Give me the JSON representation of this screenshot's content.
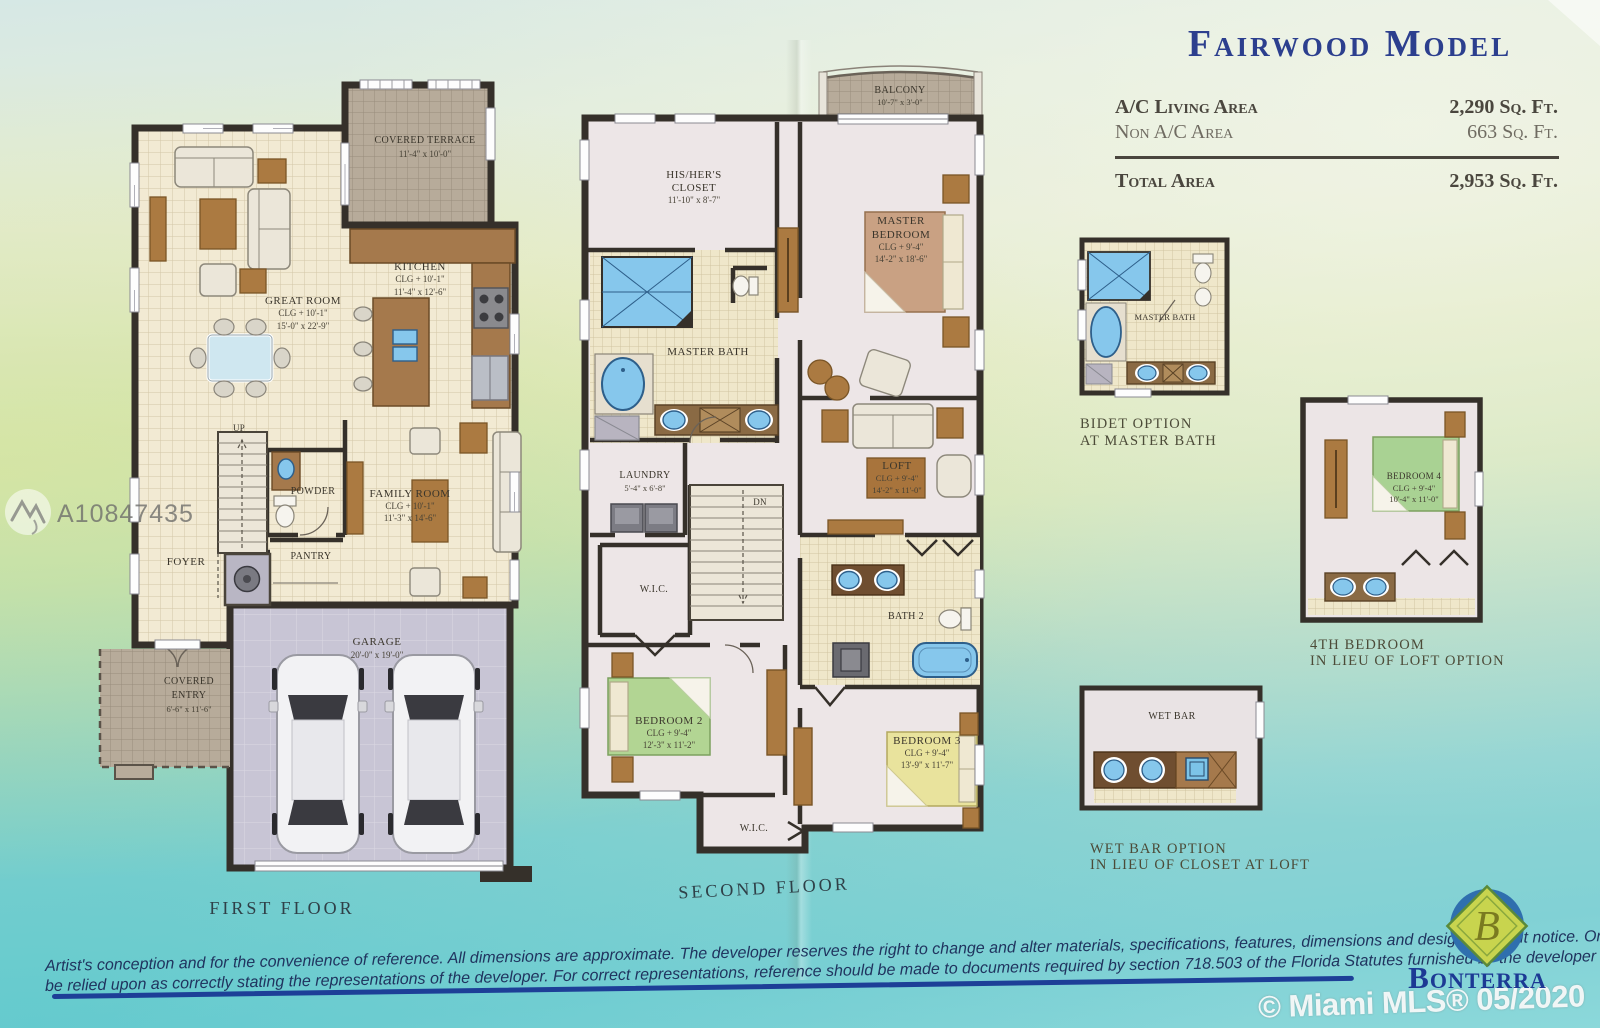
{
  "header": {
    "title": "Fairwood Model",
    "rows": [
      {
        "label": "A/C Living Area",
        "value": "2,290 Sq. Ft."
      },
      {
        "label": "Non A/C Area",
        "value": "663 Sq. Ft."
      }
    ],
    "total": {
      "label": "Total Area",
      "value": "2,953 Sq. Ft."
    }
  },
  "first_floor": {
    "caption": "FIRST FLOOR",
    "covered_terrace": {
      "name": "COVERED TERRACE",
      "dims": "11'-4\" x 10'-0\""
    },
    "great_room": {
      "name": "GREAT ROOM",
      "clg": "CLG + 10'-1\"",
      "dims": "15'-0\" x 22'-9\""
    },
    "kitchen": {
      "name": "KITCHEN",
      "clg": "CLG + 10'-1\"",
      "dims": "11'-4\" x 12'-6\""
    },
    "family_room": {
      "name": "FAMILY ROOM",
      "clg": "CLG + 10'-1\"",
      "dims": "11'-3\" x 14'-6\""
    },
    "up": "UP",
    "powder": "POWDER",
    "foyer": "FOYER",
    "pantry": "PANTRY",
    "garage": {
      "name": "GARAGE",
      "dims": "20'-0\" x 19'-0\""
    },
    "covered_entry": {
      "name": "COVERED",
      "name2": "ENTRY",
      "dims": "6'-6\" x 11'-6\""
    }
  },
  "second_floor": {
    "caption": "SECOND FLOOR",
    "balcony": {
      "name": "BALCONY",
      "dims": "10'-7\" x 3'-0\""
    },
    "closet": {
      "name": "HIS/HER'S",
      "name2": "CLOSET",
      "dims": "11'-10\" x 8'-7\""
    },
    "master_bath": "MASTER BATH",
    "master_bedroom": {
      "name": "MASTER",
      "name2": "BEDROOM",
      "clg": "CLG + 9'-4\"",
      "dims": "14'-2\" x 18'-6\""
    },
    "laundry": {
      "name": "LAUNDRY",
      "dims": "5'-4\" x 6'-8\""
    },
    "dn": "DN",
    "wic": "W.I.C.",
    "loft": {
      "name": "LOFT",
      "clg": "CLG + 9'-4\"",
      "dims": "14'-2\" x 11'-0\""
    },
    "bath2": "BATH 2",
    "bedroom2": {
      "name": "BEDROOM 2",
      "clg": "CLG + 9'-4\"",
      "dims": "12'-3\" x 11'-2\""
    },
    "bedroom3": {
      "name": "BEDROOM 3",
      "clg": "CLG + 9'-4\"",
      "dims": "13'-9\" x 11'-7\""
    },
    "wic2": "W.I.C."
  },
  "options": {
    "bidet": {
      "room": "MASTER BATH",
      "cap1": "BIDET OPTION",
      "cap2": "AT MASTER BATH"
    },
    "bedroom4": {
      "room": "BEDROOM 4",
      "clg": "CLG + 9'-4\"",
      "dims": "10'-4\" x 11'-0\"",
      "cap1": "4TH BEDROOM",
      "cap2": "IN LIEU OF LOFT OPTION"
    },
    "wetbar": {
      "room": "WET BAR",
      "cap1": "WET BAR OPTION",
      "cap2": "IN LIEU OF CLOSET AT LOFT"
    }
  },
  "footer": {
    "disclaimer1": "Artist's conception and for the convenience of reference. All dimensions are approximate. The developer reserves the right to change and alter materials, specifications, features, dimensions and designs without notice. Oral representations cannot",
    "disclaimer2": "be relied upon as correctly stating the representations of the developer. For correct representations, reference should be made to documents required by section 718.503 of the Florida Statutes furnished by the developer to the buyer or lessee."
  },
  "brand": {
    "name": "Bonterra",
    "monogram": "B"
  },
  "watermarks": {
    "listing_id": "A10847435",
    "mls": "© Miami MLS® 05/2020"
  }
}
